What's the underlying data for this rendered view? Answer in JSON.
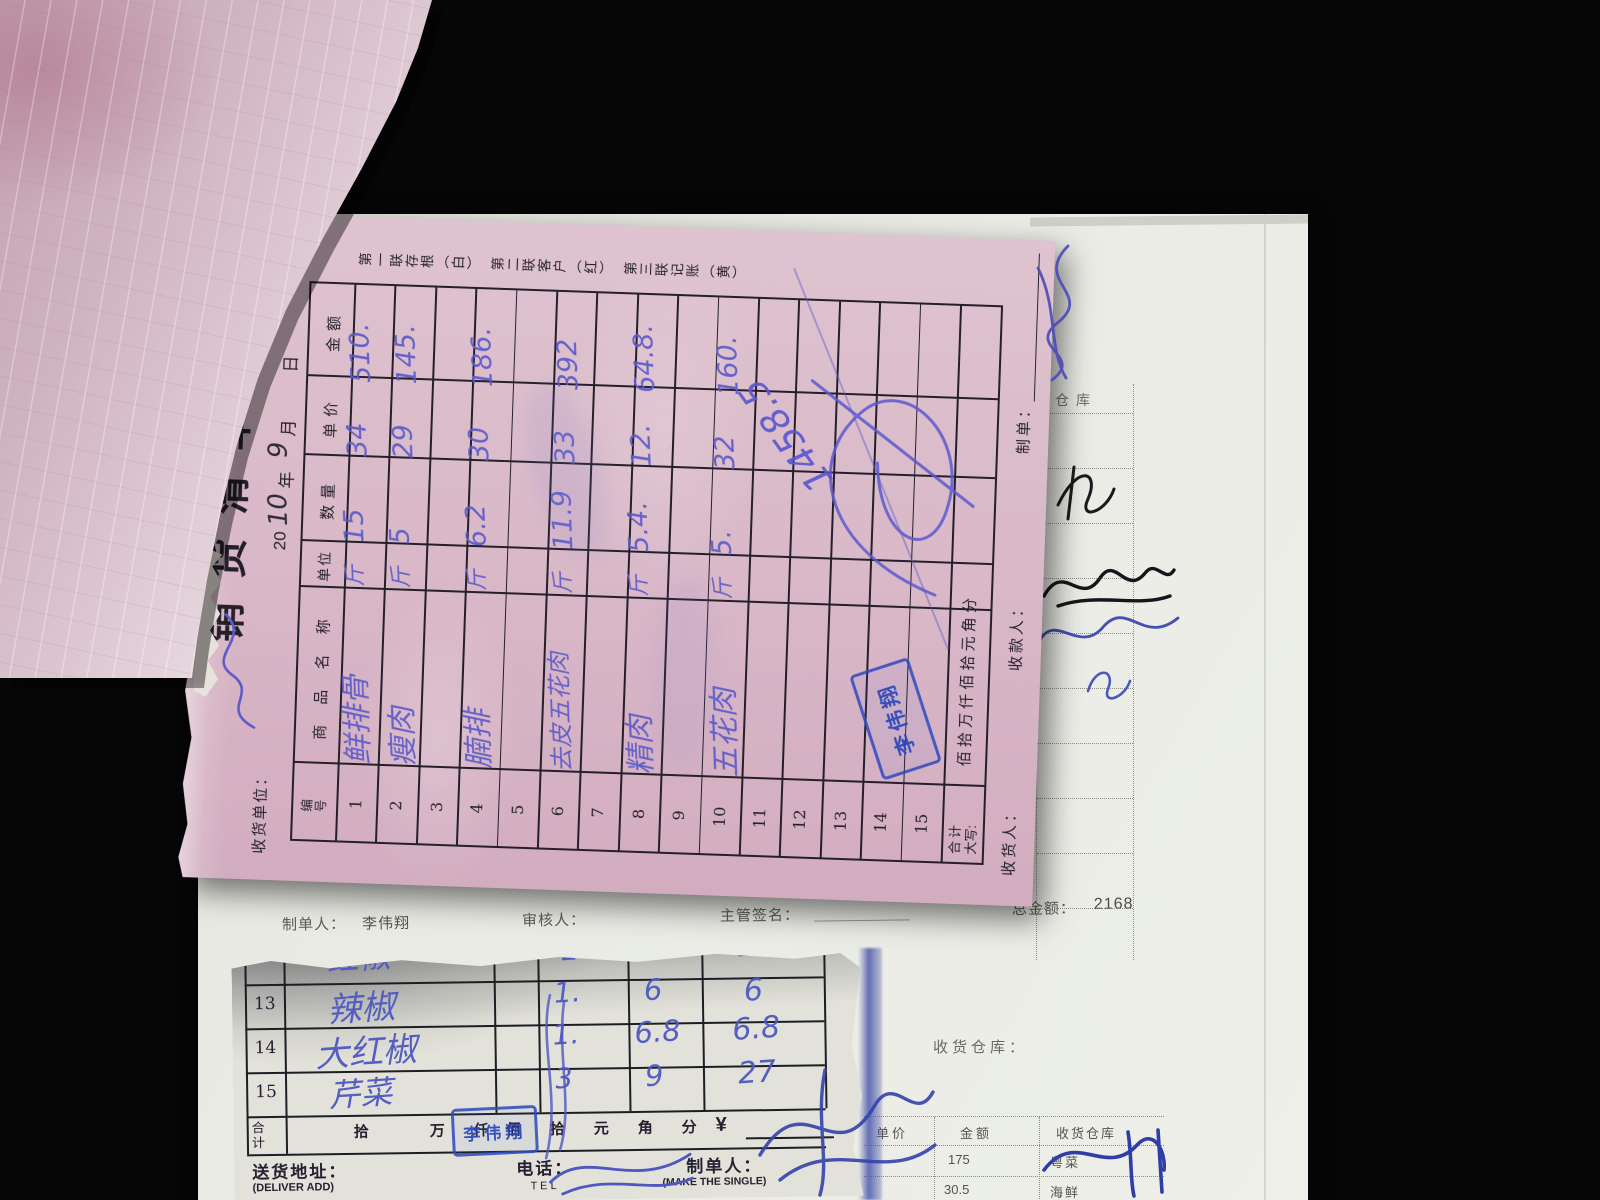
{
  "pink_form": {
    "title": "销货清单",
    "serial_symbol": "№",
    "serial_number": "006",
    "date": {
      "century": "20",
      "year_fill": "10",
      "year_char": "年",
      "month_fill": "9",
      "month_char": "月",
      "day_char": "日"
    },
    "receiver_unit_label": "收货单位：",
    "copy_note": "第一联存根（白）　第二联客户（红）　第三联记账（黄）",
    "columns": {
      "no": "编号",
      "name": "商 品 名 称",
      "unit": "单位",
      "qty": "数量",
      "price": "单价",
      "amount": "金额"
    },
    "rows": [
      {
        "no": "1",
        "name": "鲜排骨",
        "unit": "斤",
        "qty": "15",
        "price": "34",
        "amount": "510."
      },
      {
        "no": "2",
        "name": "瘦肉",
        "unit": "斤",
        "qty": "5",
        "price": "29",
        "amount": "145."
      },
      {
        "no": "3",
        "name": "",
        "unit": "",
        "qty": "",
        "price": "",
        "amount": ""
      },
      {
        "no": "4",
        "name": "腩排",
        "unit": "斤",
        "qty": "6.2",
        "price": "30",
        "amount": "186."
      },
      {
        "no": "5",
        "name": "",
        "unit": "",
        "qty": "",
        "price": "",
        "amount": ""
      },
      {
        "no": "6",
        "name": "去皮五花肉",
        "unit": "斤",
        "qty": "11.9",
        "price": "33",
        "amount": "392"
      },
      {
        "no": "7",
        "name": "",
        "unit": "",
        "qty": "",
        "price": "",
        "amount": ""
      },
      {
        "no": "8",
        "name": "精肉",
        "unit": "斤",
        "qty": "5.4.",
        "price": "12.",
        "amount": "64.8."
      },
      {
        "no": "9",
        "name": "",
        "unit": "",
        "qty": "",
        "price": "",
        "amount": ""
      },
      {
        "no": "10",
        "name": "五花肉",
        "unit": "斤",
        "qty": "5.",
        "price": "32",
        "amount": "160."
      },
      {
        "no": "11",
        "name": "",
        "unit": "",
        "qty": "",
        "price": "",
        "amount": ""
      },
      {
        "no": "12",
        "name": "",
        "unit": "",
        "qty": "",
        "price": "",
        "amount": ""
      },
      {
        "no": "13",
        "name": "",
        "unit": "",
        "qty": "",
        "price": "",
        "amount": ""
      },
      {
        "no": "14",
        "name": "",
        "unit": "",
        "qty": "",
        "price": "",
        "amount": ""
      },
      {
        "no": "15",
        "name": "",
        "unit": "",
        "qty": "",
        "price": "",
        "amount": ""
      }
    ],
    "total_label": "合计",
    "caps_label": "大写:",
    "caps_digits": "佰 拾 万 仟 佰 拾 元 角 分",
    "grand_total_handwritten": "1458.5",
    "receiver_label": "收货人：",
    "payee_label": "收款人：",
    "maker_label": "制单：",
    "stamp_name": "李伟翔"
  },
  "printed_sheet": {
    "maker_label": "制单人：",
    "maker_name": "李伟翔",
    "auditor_label": "审核人：",
    "supervisor_label": "主管签名：",
    "grand_total_label": "总金额：",
    "grand_total_value": "2168",
    "warehouse_heading": "收货仓库：",
    "warehouse_col_partial": "仓库",
    "table": {
      "headers": {
        "price": "单价",
        "amount": "金额",
        "warehouse": "收货仓库"
      },
      "rows": [
        {
          "amount": "175",
          "warehouse": "粤菜"
        },
        {
          "amount": "30.5",
          "warehouse": "海鲜"
        }
      ]
    }
  },
  "bottom_form": {
    "rows": [
      {
        "no": "12",
        "name": "红椒",
        "qty": "2",
        "price": "5",
        "amount": "11"
      },
      {
        "no": "13",
        "name": "辣椒",
        "qty": "1.",
        "price": "6",
        "amount": "6"
      },
      {
        "no": "14",
        "name": "大红椒",
        "qty": "1.",
        "price": "6.8",
        "amount": "6.8"
      },
      {
        "no": "15",
        "name": "芹菜",
        "qty": "3",
        "price": "9",
        "amount": "27"
      }
    ],
    "total_label": "合计",
    "caps_digits": [
      "拾",
      "万",
      "仟",
      "佰",
      "拾",
      "元",
      "角",
      "分"
    ],
    "currency": "¥",
    "stamp_name": "李伟翔",
    "footer": {
      "address_label": "送货地址：",
      "address_en": "(DELIVER ADD)",
      "tel_label": "电话：",
      "tel_en": "T E L",
      "maker_label": "制单人：",
      "maker_en": "(MAKE THE SINGLE)"
    }
  }
}
